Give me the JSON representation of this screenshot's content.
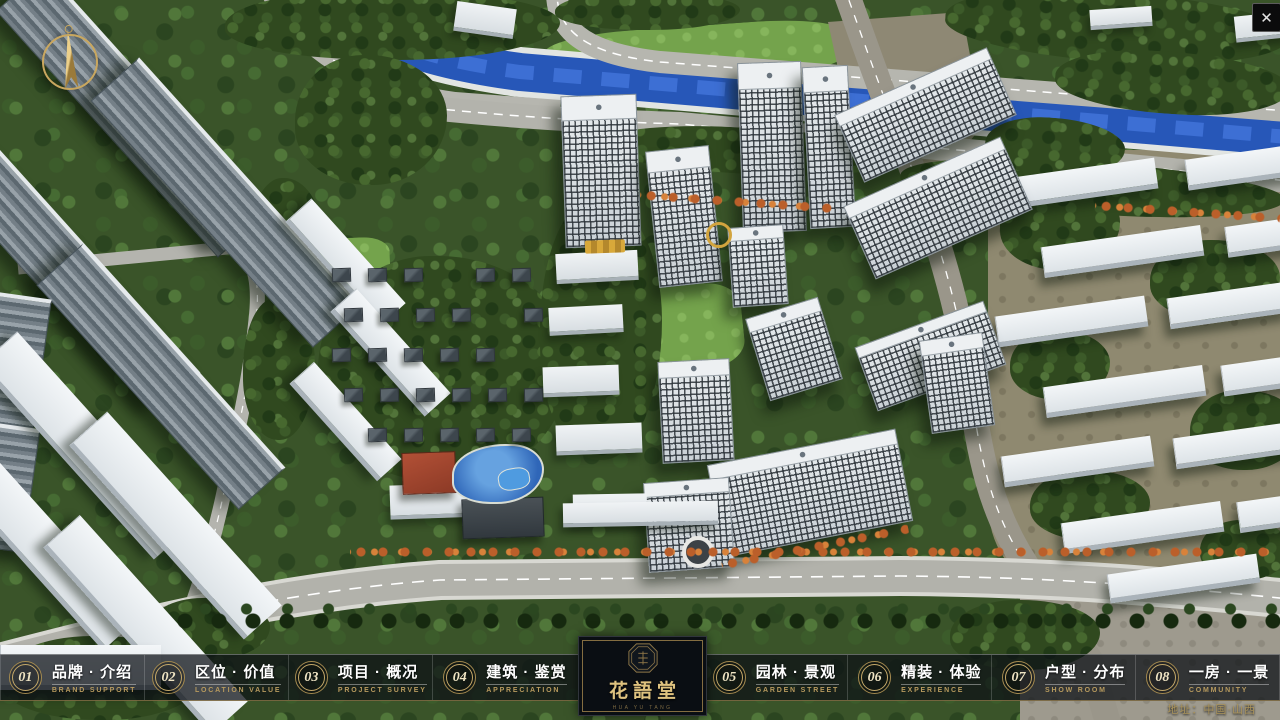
{
  "window": {
    "close_label": "✕"
  },
  "icons": {
    "compass": "north-compass",
    "close": "close-x",
    "seal": "octagon-seal"
  },
  "navbar": {
    "items": [
      {
        "num": "01",
        "zh": "品牌 · 介绍",
        "en": "BRAND SUPPORT"
      },
      {
        "num": "02",
        "zh": "区位 · 价值",
        "en": "LOCATION VALUE"
      },
      {
        "num": "03",
        "zh": "项目 · 概况",
        "en": "PROJECT SURVEY"
      },
      {
        "num": "04",
        "zh": "建筑 · 鉴赏",
        "en": "APPRECIATION"
      },
      {
        "num": "05",
        "zh": "园林 · 景观",
        "en": "GARDEN STREET"
      },
      {
        "num": "06",
        "zh": "精装 · 体验",
        "en": "EXPERIENCE"
      },
      {
        "num": "07",
        "zh": "户型 · 分布",
        "en": "SHOW ROOM"
      },
      {
        "num": "08",
        "zh": "一房 · 一景",
        "en": "COMMUNITY"
      }
    ]
  },
  "logo": {
    "title": "花語堂",
    "subtitle": "HUA YU TANG"
  },
  "footer": {
    "address": "地址：中国·山西"
  },
  "colors": {
    "gold": "#c3a76e",
    "bar_bg": "rgba(12,16,21,0.74)",
    "river": "#2757b8"
  }
}
